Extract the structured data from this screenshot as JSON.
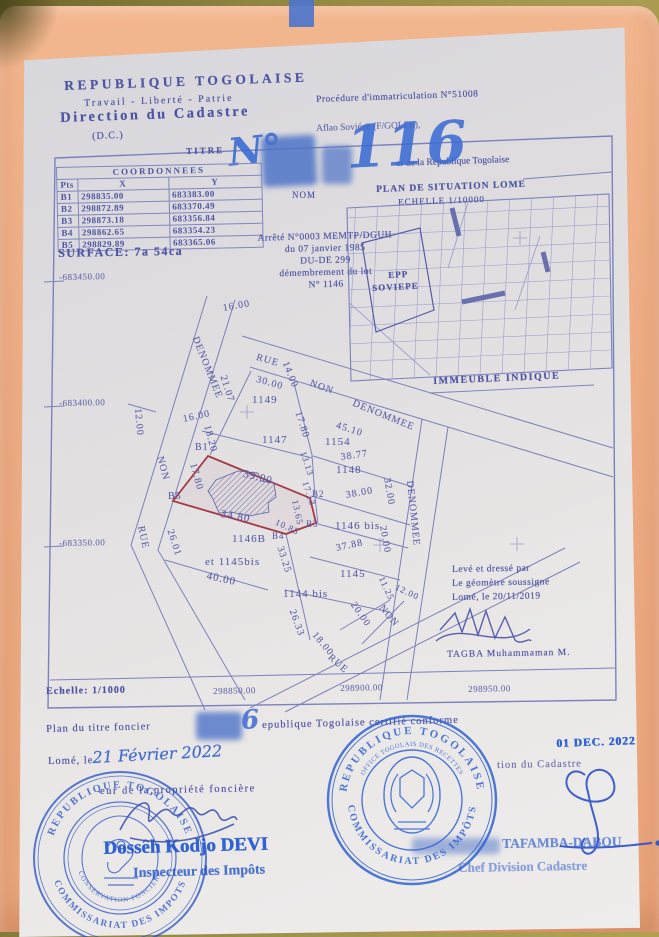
{
  "header": {
    "country": "REPUBLIQUE TOGOLAISE",
    "motto": "Travail - Liberté - Patrie",
    "office": "Direction du Cadastre",
    "office_abbr": "(D.C.)",
    "doc_type": "TITRE",
    "procedure": "Procédure d'immatriculation N°51008",
    "affaire": "Aflao Soviépe (F/GOLFE),",
    "number_prefix": "N°",
    "number_value": "116",
    "registry_line": "er de la République Togolaise",
    "nom_label": "NOM"
  },
  "coordinates": {
    "title": "COORDONNEES",
    "col_pts": "Pts",
    "col_x": "X",
    "col_y": "Y",
    "rows": [
      [
        "B1",
        "298835.00",
        "683383.00"
      ],
      [
        "B2",
        "298872.89",
        "683370.49"
      ],
      [
        "B3",
        "298873.18",
        "683356.84"
      ],
      [
        "B4",
        "298862.65",
        "683354.23"
      ],
      [
        "B5",
        "298829.89",
        "683365.06"
      ]
    ],
    "surface": "SURFACE: 7a 54ca"
  },
  "arrete": {
    "lines": [
      "Arrêté N°0003 MEMTP/DGUH",
      "du 07 janvier 1985",
      "DU-DE 299",
      "démembrement du lot",
      "N° 1146"
    ]
  },
  "situation": {
    "title": "PLAN DE SITUATION LOME",
    "scale": "ECHELLE 1/10000",
    "school_line1": "EPP",
    "school_line2": "SOVIEPE",
    "indicated": "IMMEUBLE INDIQUE"
  },
  "plan": {
    "scale": "Echelle: 1/1000",
    "y_axis": [
      {
        "t": "-683450.00",
        "x": 59,
        "y": 272,
        "r": -1
      },
      {
        "t": "-683400.00",
        "x": 59,
        "y": 398,
        "r": -1
      },
      {
        "t": "-683350.00",
        "x": 59,
        "y": 538,
        "r": -1
      }
    ],
    "x_axis": [
      {
        "t": "298850.00",
        "x": 213,
        "y": 686,
        "r": -1
      },
      {
        "t": "298900.00",
        "x": 340,
        "y": 683,
        "r": -1
      },
      {
        "t": "298950.00",
        "x": 468,
        "y": 684,
        "r": -1
      }
    ],
    "labels": [
      {
        "t": "16.00",
        "x": 222,
        "y": 303,
        "r": -10
      },
      {
        "t": "DENOMMEE",
        "x": 200,
        "y": 335,
        "r": 68
      },
      {
        "t": "RUE",
        "x": 258,
        "y": 352,
        "r": 16
      },
      {
        "t": "30.00",
        "x": 258,
        "y": 374,
        "r": 16
      },
      {
        "t": "14.00",
        "x": 290,
        "y": 360,
        "r": 68
      },
      {
        "t": "NON",
        "x": 312,
        "y": 378,
        "r": 20
      },
      {
        "t": "DENOMMEE",
        "x": 355,
        "y": 398,
        "r": 22
      },
      {
        "t": "45.10",
        "x": 338,
        "y": 420,
        "r": 18
      },
      {
        "t": "21.07",
        "x": 228,
        "y": 374,
        "r": 72
      },
      {
        "t": "1149",
        "x": 252,
        "y": 394,
        "r": 0,
        "s": 11
      },
      {
        "t": "16.00",
        "x": 182,
        "y": 414,
        "r": -12
      },
      {
        "t": "18.20",
        "x": 212,
        "y": 424,
        "r": 75
      },
      {
        "t": "12.00",
        "x": 143,
        "y": 408,
        "r": 85
      },
      {
        "t": "1147",
        "x": 262,
        "y": 434,
        "r": 0,
        "s": 11
      },
      {
        "t": "17.80",
        "x": 303,
        "y": 410,
        "r": 72
      },
      {
        "t": "1154",
        "x": 325,
        "y": 436,
        "r": 0,
        "s": 11
      },
      {
        "t": "38.77",
        "x": 340,
        "y": 452,
        "r": -8
      },
      {
        "t": "1148",
        "x": 336,
        "y": 464,
        "r": 0,
        "s": 11
      },
      {
        "t": "13.13",
        "x": 308,
        "y": 450,
        "r": 72,
        "s": 9
      },
      {
        "t": "17.13",
        "x": 310,
        "y": 480,
        "r": 72,
        "s": 9
      },
      {
        "t": "B1",
        "x": 195,
        "y": 442,
        "r": 0
      },
      {
        "t": "17.80",
        "x": 198,
        "y": 462,
        "r": 75
      },
      {
        "t": "39.90",
        "x": 245,
        "y": 468,
        "r": 14,
        "s": 11
      },
      {
        "t": "B5",
        "x": 168,
        "y": 491,
        "r": 0
      },
      {
        "t": "B2",
        "x": 312,
        "y": 489,
        "r": 0,
        "s": 9
      },
      {
        "t": "13.65",
        "x": 300,
        "y": 499,
        "r": 78,
        "s": 9
      },
      {
        "t": "38.00",
        "x": 345,
        "y": 490,
        "r": -10
      },
      {
        "t": "32.00",
        "x": 392,
        "y": 477,
        "r": 80
      },
      {
        "t": "DENOMMEE",
        "x": 415,
        "y": 480,
        "r": 84
      },
      {
        "t": "34.80",
        "x": 222,
        "y": 508,
        "r": 10,
        "s": 11
      },
      {
        "t": "10.85",
        "x": 278,
        "y": 517,
        "r": 25,
        "s": 9
      },
      {
        "t": "B4",
        "x": 272,
        "y": 531,
        "r": 0,
        "s": 9
      },
      {
        "t": "B3",
        "x": 306,
        "y": 519,
        "r": 0,
        "s": 9
      },
      {
        "t": "1146 bis",
        "x": 335,
        "y": 520,
        "r": 0,
        "s": 11
      },
      {
        "t": "20.00",
        "x": 388,
        "y": 525,
        "r": 80
      },
      {
        "t": "NON",
        "x": 165,
        "y": 455,
        "r": 75
      },
      {
        "t": "26.01",
        "x": 175,
        "y": 528,
        "r": 72
      },
      {
        "t": "RUE",
        "x": 146,
        "y": 525,
        "r": 78
      },
      {
        "t": "1146B",
        "x": 232,
        "y": 533,
        "r": 0,
        "s": 11
      },
      {
        "t": "et 1145bis",
        "x": 205,
        "y": 556,
        "r": 0,
        "s": 11
      },
      {
        "t": "40.00",
        "x": 208,
        "y": 570,
        "r": 12,
        "s": 11
      },
      {
        "t": "33.25",
        "x": 285,
        "y": 545,
        "r": 72
      },
      {
        "t": "37.88",
        "x": 335,
        "y": 543,
        "r": -12
      },
      {
        "t": "1145",
        "x": 340,
        "y": 568,
        "r": 0,
        "s": 11
      },
      {
        "t": "1144 bis",
        "x": 283,
        "y": 588,
        "r": 0,
        "s": 11
      },
      {
        "t": "26.33",
        "x": 297,
        "y": 608,
        "r": 70
      },
      {
        "t": "11.25",
        "x": 386,
        "y": 575,
        "r": 65,
        "s": 9
      },
      {
        "t": "12.00",
        "x": 398,
        "y": 582,
        "r": 25,
        "s": 9
      },
      {
        "t": "20.00",
        "x": 357,
        "y": 600,
        "r": 55
      },
      {
        "t": "NON",
        "x": 385,
        "y": 603,
        "r": 50
      },
      {
        "t": "18.00",
        "x": 318,
        "y": 630,
        "r": 50
      },
      {
        "t": "RUE",
        "x": 333,
        "y": 652,
        "r": 42
      }
    ]
  },
  "surveyor": {
    "line1": "Levé et dressé par",
    "line2": "Le géomètre soussigné",
    "line3": "Lomé, le 20/11/2019",
    "name": "TAGBA Muhammaman M."
  },
  "certification": {
    "line_prefix": "Plan du titre foncier",
    "number_tail": "6",
    "line_suffix": "epublique Togolaise certifié conforme",
    "date_stamp": "01 DEC. 2022",
    "place_label": "Lomé, le",
    "date_hand": "21 Février 2022",
    "cadastre_ref": "tion du Cadastre",
    "conservator_line": "eur de la propriété foncière"
  },
  "officials": {
    "left_name": "Dossêh Kodjo DEVI",
    "left_title": "Inspecteur des Impôts",
    "right_name": "TAFAMBA-DABOU",
    "right_title": "Chef Division Cadastre"
  },
  "stamps": {
    "left": {
      "ring_top": "REPUBLIQUE TOGOLAISE",
      "ring_bottom": "COMMISSARIAT DES IMPOTS",
      "inner": "CONSERVATION FONCIERE"
    },
    "right": {
      "ring_top": "REPUBLIQUE TOGOLAISE",
      "ring_top2": "OFFICE TOGOLAIS DES RECETTES",
      "ring_bottom": "COMMISSARIAT DES IMPÔTS"
    }
  },
  "colors": {
    "ink": "#4d55a2",
    "stamp_blue": "#2f63d4",
    "parcel_red": "#a33a45",
    "folder": "#efae86"
  }
}
